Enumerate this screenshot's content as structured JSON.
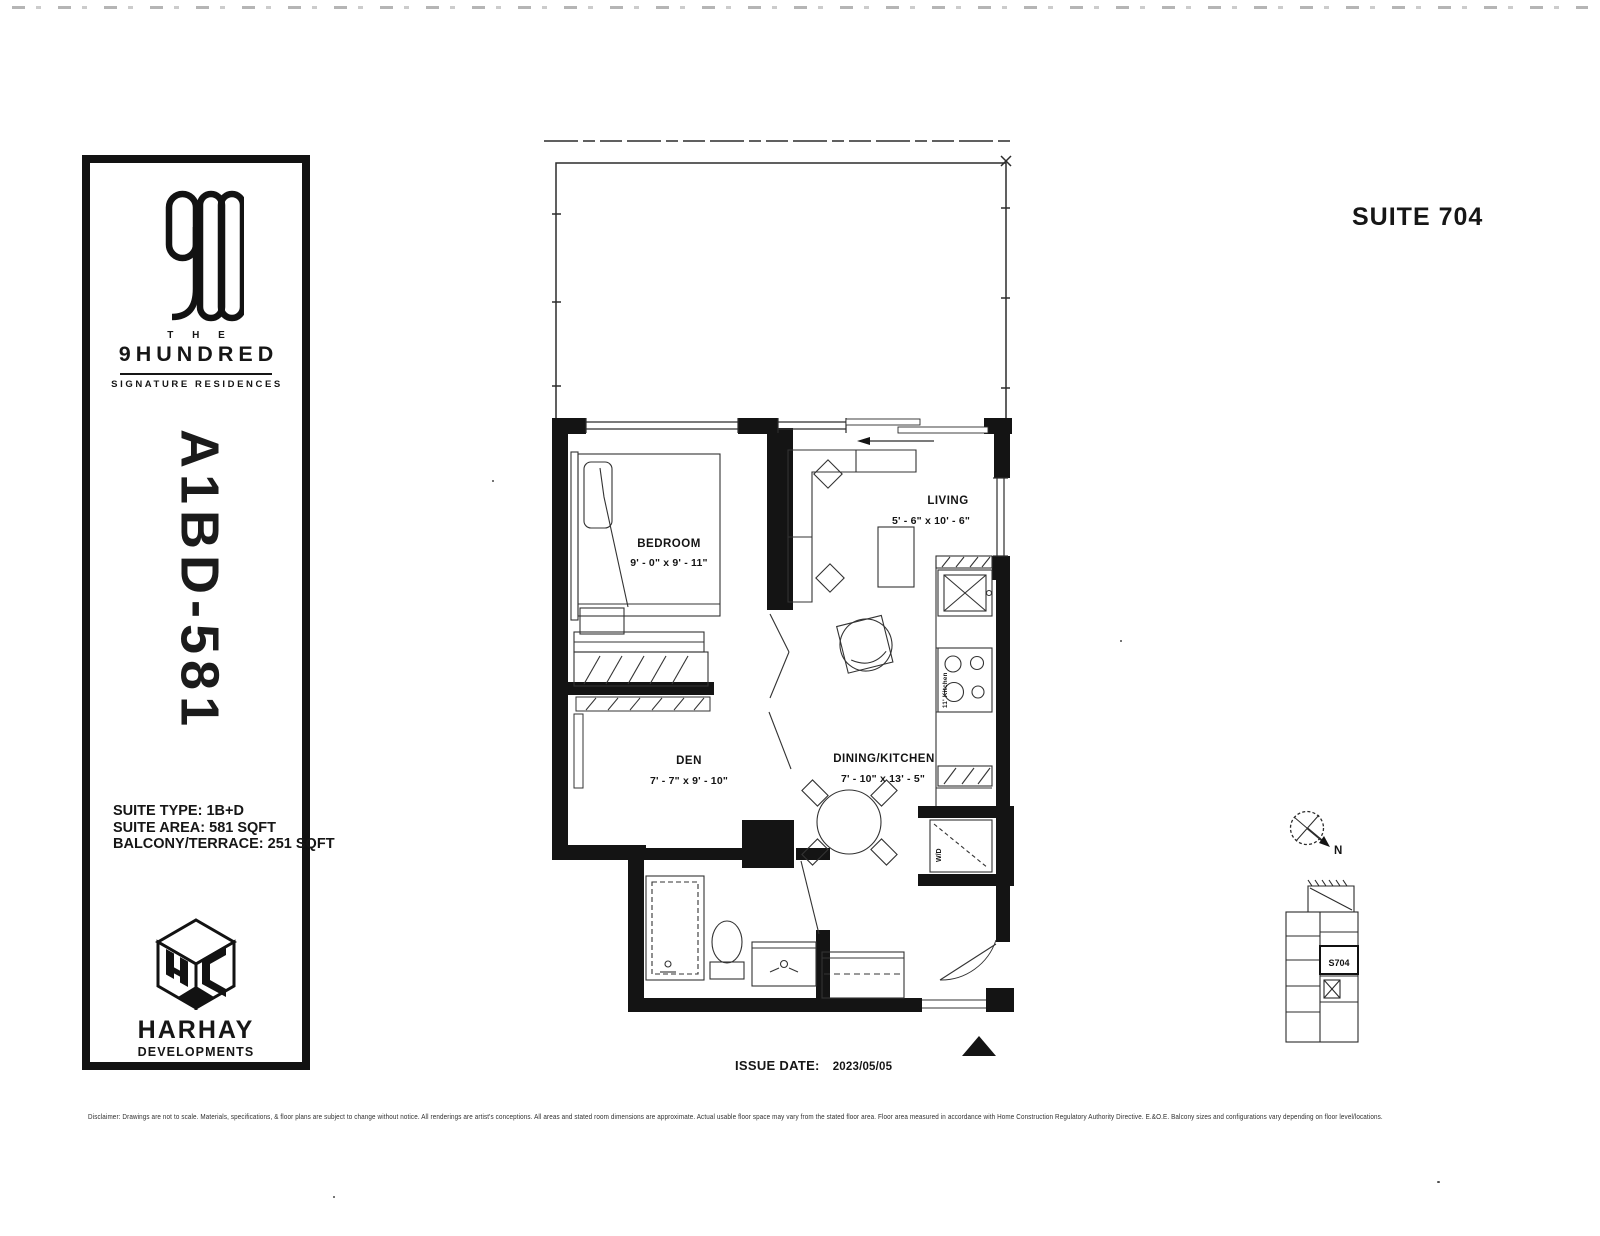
{
  "page": {
    "title": "SUITE 704"
  },
  "brand": {
    "the": "T H E",
    "name": "9HUNDRED",
    "tagline": "SIGNATURE RESIDENCES"
  },
  "plan": {
    "code": "A1BD-581"
  },
  "suite_info": {
    "type": "SUITE TYPE: 1B+D",
    "area": "SUITE AREA: 581 SQFT",
    "balcony": "BALCONY/TERRACE: 251 SQFT"
  },
  "developer": {
    "name": "HARHAY",
    "division": "DEVELOPMENTS"
  },
  "rooms": {
    "bedroom": {
      "name": "BEDROOM",
      "dims": "9' - 0\" x 9' - 11\""
    },
    "living": {
      "name": "LIVING",
      "dims": "5' - 6\" x 10' - 6\""
    },
    "den": {
      "name": "DEN",
      "dims": "7' - 7\" x 9' - 10\""
    },
    "dining_kitchen": {
      "name": "DINING/KITCHEN",
      "dims": "7' - 10\" x 13' - 5\""
    },
    "wd": "W/D",
    "kitchen_note": "11' Kitchen"
  },
  "annotations": {
    "north": "N",
    "keyplan_unit": "S704"
  },
  "issue": {
    "label": "ISSUE DATE:",
    "date": "2023/05/05"
  },
  "disclaimer": "Disclaimer: Drawings are not to scale. Materials, specifications, & floor plans are subject to change without notice. All renderings are artist's conceptions. All areas and stated room dimensions are approximate. Actual usable floor space may vary from the stated floor area. Floor area measured in accordance with Home Construction Regulatory Authority Directive. E.&O.E. Balcony sizes and configurations vary depending on floor level/locations.",
  "colors": {
    "ink": "#161616",
    "paper": "#ffffff"
  }
}
